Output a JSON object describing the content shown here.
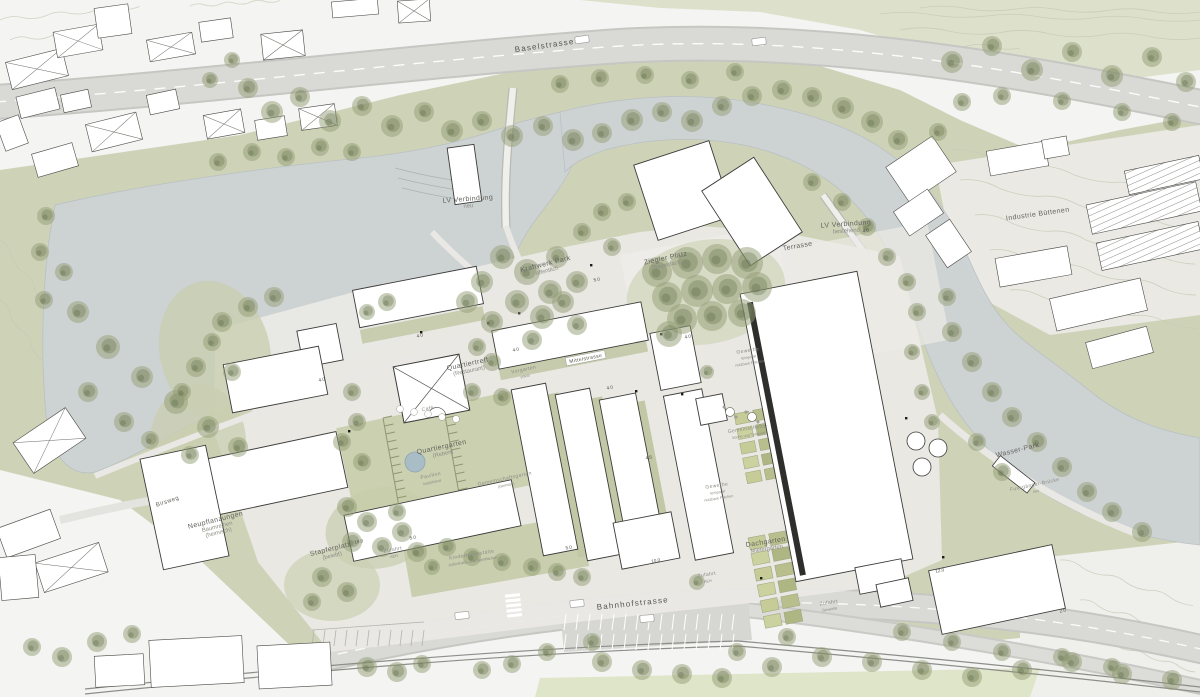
{
  "plan": {
    "type": "architectural-site-plan",
    "colors": {
      "paper": "#f4f4f2",
      "water": "#cdd2d4",
      "green_base": "#ced3b8",
      "green_garden": "#c7cdaa",
      "tree": "#94a076",
      "road": "#d9d9d5",
      "road_edge": "#c6c6c2",
      "ground": "#eae9e5",
      "building_fill": "#ffffff",
      "building_stroke": "#3b3b39",
      "label_street": "#55554f",
      "label_area": "#64645e",
      "label_sub": "#8c8c84"
    },
    "labels": [
      {
        "id": "baselstrasse",
        "kind": "street",
        "text": "Baselstrasse",
        "subs": [],
        "x": 545,
        "y": 48,
        "rot": -8
      },
      {
        "id": "bahnhofstrasse",
        "kind": "street",
        "text": "Bahnhofstrasse",
        "subs": [],
        "x": 633,
        "y": 606,
        "rot": -6
      },
      {
        "id": "birsweg",
        "kind": "small",
        "text": "Birsweg",
        "subs": [],
        "x": 168,
        "y": 503,
        "rot": -18
      },
      {
        "id": "lv-verbindung-neu",
        "kind": "area",
        "text": "LV Verbindung",
        "subs": [
          "neu"
        ],
        "x": 468,
        "y": 201,
        "rot": -4
      },
      {
        "id": "lv-verbindung-bestehend",
        "kind": "area",
        "text": "LV Verbindung",
        "subs": [
          "bestehend"
        ],
        "x": 846,
        "y": 226,
        "rot": -4
      },
      {
        "id": "industrie-buettenen",
        "kind": "area",
        "text": "Industrie Büttenen",
        "subs": [],
        "x": 1038,
        "y": 216,
        "rot": -8
      },
      {
        "id": "kraftwerk-park",
        "kind": "area",
        "text": "Kraftwerk Park",
        "subs": [
          "öffentlich"
        ],
        "x": 546,
        "y": 266,
        "rot": -14
      },
      {
        "id": "ziegler-platz",
        "kind": "area",
        "text": "Ziegler Platz",
        "subs": [
          "(Baumdach)"
        ],
        "x": 666,
        "y": 260,
        "rot": -12
      },
      {
        "id": "terrasse",
        "kind": "area",
        "text": "Terrasse",
        "subs": [],
        "x": 798,
        "y": 248,
        "rot": -10
      },
      {
        "id": "quartiertreff",
        "kind": "area",
        "text": "Quartiertreff",
        "subs": [
          "(Restaurant)"
        ],
        "x": 468,
        "y": 366,
        "rot": -12
      },
      {
        "id": "cafe",
        "kind": "tiny",
        "text": "Café",
        "subs": [],
        "x": 428,
        "y": 410,
        "rot": -12
      },
      {
        "id": "vorgarten",
        "kind": "tiny",
        "text": "Vorgarten",
        "subs": [
          "privat"
        ],
        "x": 524,
        "y": 371,
        "rot": -12
      },
      {
        "id": "mittelstrasse",
        "kind": "box",
        "text": "Mittelstrasse",
        "subs": [],
        "x": 586,
        "y": 360,
        "rot": -11
      },
      {
        "id": "quartiergarten",
        "kind": "area",
        "text": "Quartiergarten",
        "subs": [
          "(Reben)"
        ],
        "x": 442,
        "y": 449,
        "rot": -12
      },
      {
        "id": "pavillon",
        "kind": "tiny",
        "text": "Pavillon",
        "subs": [
          "bestehend"
        ],
        "x": 431,
        "y": 477,
        "rot": -12
      },
      {
        "id": "gemeinschaftsgarten",
        "kind": "tiny",
        "text": "Gemeinschaftsgarten",
        "subs": [
          "(Gemüse)"
        ],
        "x": 505,
        "y": 480,
        "rot": -12
      },
      {
        "id": "gewerbe-1",
        "kind": "tiny",
        "text": "Gewerbe",
        "subs": [
          "temporär",
          "nutzbare Flächen"
        ],
        "x": 748,
        "y": 352,
        "rot": -9
      },
      {
        "id": "gemeinschaftskueche",
        "kind": "tiny",
        "text": "Gemeinschafts-",
        "subs": [
          "küche und Terrasse"
        ],
        "x": 748,
        "y": 430,
        "rot": -9
      },
      {
        "id": "gewerbe-2",
        "kind": "tiny",
        "text": "Gewerbe",
        "subs": [
          "temporär",
          "nutzbare Flächen"
        ],
        "x": 717,
        "y": 487,
        "rot": -9
      },
      {
        "id": "dachgarten",
        "kind": "area",
        "text": "Dachgarten",
        "subs": [
          "Mietergärten"
        ],
        "x": 766,
        "y": 544,
        "rot": -9
      },
      {
        "id": "wasser-park",
        "kind": "area",
        "text": "Wasser-Park",
        "subs": [],
        "x": 1018,
        "y": 452,
        "rot": -14
      },
      {
        "id": "fussgaenger-bruecke",
        "kind": "tiny",
        "text": "Fussgänger-Brücke",
        "subs": [
          "neu"
        ],
        "x": 1035,
        "y": 486,
        "rot": -12
      },
      {
        "id": "neupflanzungen",
        "kind": "area",
        "text": "Neupflanzungen",
        "subs": [
          "Baumreihen",
          "(heimisch)"
        ],
        "x": 216,
        "y": 522,
        "rot": -14
      },
      {
        "id": "stapferplatz",
        "kind": "area",
        "text": "Stapferplatz",
        "subs": [
          "(belebt)"
        ],
        "x": 331,
        "y": 551,
        "rot": -14
      },
      {
        "id": "kindertagesstaette",
        "kind": "tiny",
        "text": "Kindertagesstätte",
        "subs": [
          "Aufenthalts- und Spielflächen"
        ],
        "x": 472,
        "y": 556,
        "rot": -9
      },
      {
        "id": "zufahrt-aeh-1",
        "kind": "tiny",
        "text": "Zufahrt",
        "subs": [
          "AEH"
        ],
        "x": 393,
        "y": 551,
        "rot": -10
      },
      {
        "id": "zufahrt-aeh-2",
        "kind": "tiny",
        "text": "Zufahrt",
        "subs": [
          "AEH"
        ],
        "x": 707,
        "y": 576,
        "rot": -9
      },
      {
        "id": "zufahrt-gewerbe",
        "kind": "tiny",
        "text": "Zufahrt",
        "subs": [
          "Gewerbe"
        ],
        "x": 829,
        "y": 604,
        "rot": -9
      }
    ],
    "storey_annotations": [
      {
        "v": "4.0",
        "x": 420,
        "y": 337
      },
      {
        "v": "4.0",
        "x": 322,
        "y": 381
      },
      {
        "v": "4.0",
        "x": 516,
        "y": 351
      },
      {
        "v": "5.0",
        "x": 597,
        "y": 281
      },
      {
        "v": "4.0",
        "x": 610,
        "y": 389
      },
      {
        "v": "4.5",
        "x": 649,
        "y": 459
      },
      {
        "v": "5.0",
        "x": 413,
        "y": 539
      },
      {
        "v": "10.0",
        "x": 359,
        "y": 543
      },
      {
        "v": "5.0",
        "x": 569,
        "y": 549
      },
      {
        "v": "10.0",
        "x": 656,
        "y": 562
      },
      {
        "v": "12.0",
        "x": 940,
        "y": 572
      },
      {
        "v": "2.0",
        "x": 1063,
        "y": 612
      },
      {
        "v": "4.0",
        "x": 866,
        "y": 232
      },
      {
        "v": "4.0",
        "x": 688,
        "y": 338
      }
    ]
  }
}
